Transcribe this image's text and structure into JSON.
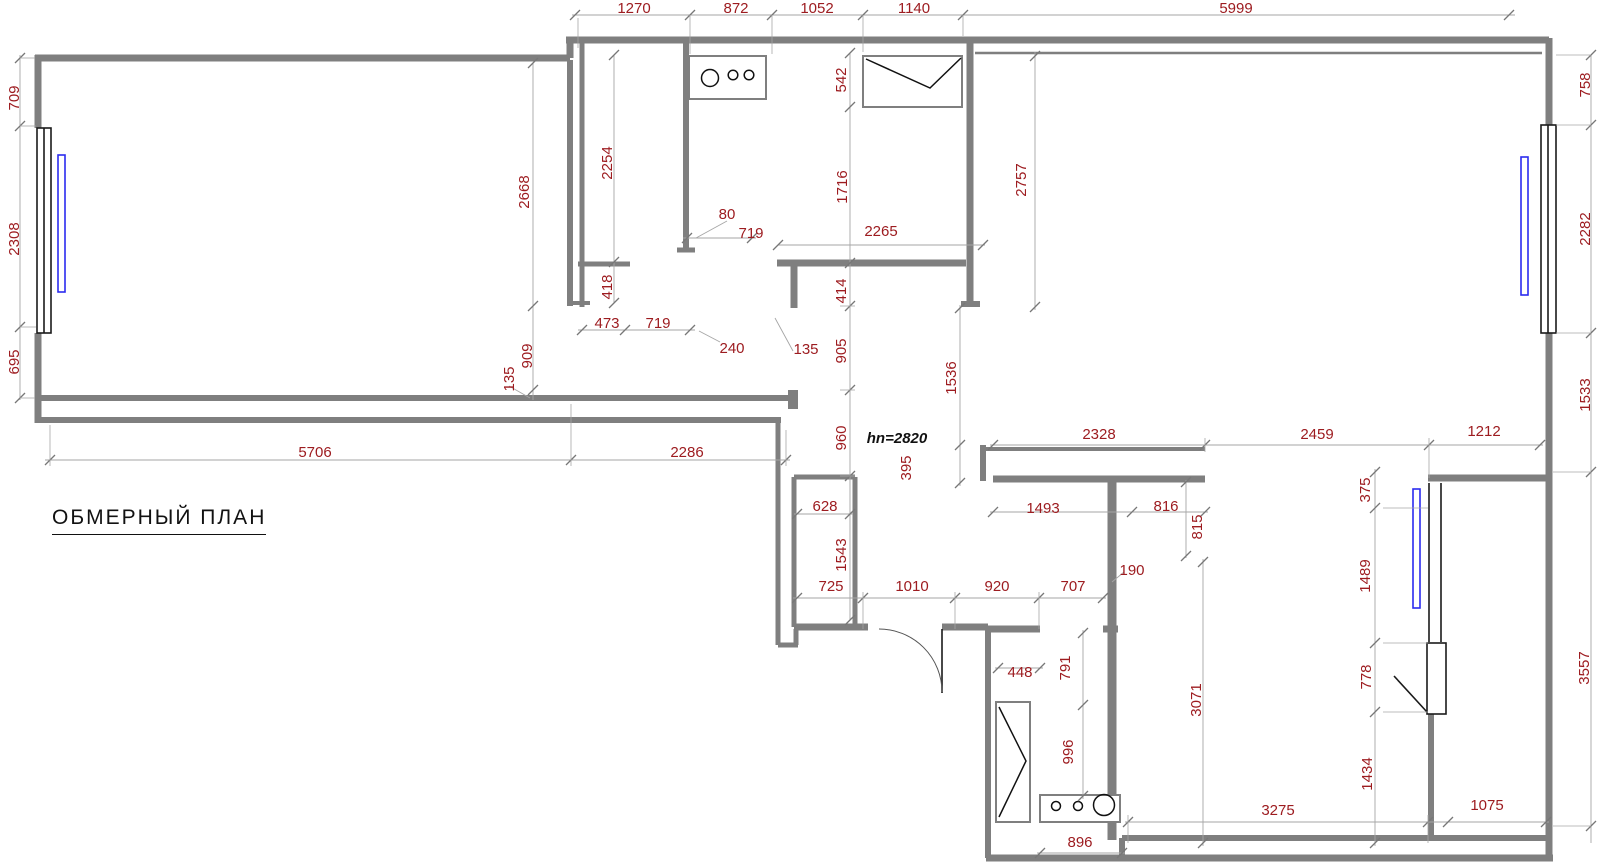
{
  "title": "ОБМЕРНЫЙ ПЛАН",
  "note": "hn=2820",
  "colors": {
    "background": "#ffffff",
    "wall": "#7f7f7f",
    "dimension_text": "#9d1c20",
    "dimension_line": "#a6a6a6",
    "window": "#1a1a1a",
    "radiator": "#2b2bee",
    "fixture": "#111111",
    "title": "#111111"
  },
  "dimensions": [
    {
      "label": "1270",
      "x": 634,
      "y": 13,
      "o": "h"
    },
    {
      "label": "872",
      "x": 736,
      "y": 13,
      "o": "h"
    },
    {
      "label": "1052",
      "x": 817,
      "y": 13,
      "o": "h"
    },
    {
      "label": "1140",
      "x": 914,
      "y": 13,
      "o": "h"
    },
    {
      "label": "5999",
      "x": 1236,
      "y": 13,
      "o": "h"
    },
    {
      "label": "709",
      "x": 19,
      "y": 98,
      "o": "v"
    },
    {
      "label": "2308",
      "x": 19,
      "y": 239,
      "o": "v"
    },
    {
      "label": "695",
      "x": 19,
      "y": 362,
      "o": "v"
    },
    {
      "label": "758",
      "x": 1590,
      "y": 85,
      "o": "v"
    },
    {
      "label": "2282",
      "x": 1590,
      "y": 229,
      "o": "v"
    },
    {
      "label": "1533",
      "x": 1590,
      "y": 395,
      "o": "v"
    },
    {
      "label": "3557",
      "x": 1589,
      "y": 668,
      "o": "v"
    },
    {
      "label": "2668",
      "x": 529,
      "y": 192,
      "o": "v"
    },
    {
      "label": "909",
      "x": 532,
      "y": 356,
      "o": "v"
    },
    {
      "label": "135",
      "x": 514,
      "y": 379,
      "o": "v"
    },
    {
      "label": "5706",
      "x": 315,
      "y": 457,
      "o": "h"
    },
    {
      "label": "2286",
      "x": 687,
      "y": 457,
      "o": "h"
    },
    {
      "label": "2254",
      "x": 612,
      "y": 163,
      "o": "v"
    },
    {
      "label": "418",
      "x": 612,
      "y": 287,
      "o": "v"
    },
    {
      "label": "473",
      "x": 607,
      "y": 328,
      "o": "h"
    },
    {
      "label": "719",
      "x": 658,
      "y": 328,
      "o": "h"
    },
    {
      "label": "80",
      "x": 727,
      "y": 219,
      "o": "h"
    },
    {
      "label": "719",
      "x": 751,
      "y": 238,
      "o": "h"
    },
    {
      "label": "240",
      "x": 732,
      "y": 353,
      "o": "h"
    },
    {
      "label": "542",
      "x": 846,
      "y": 80,
      "o": "v"
    },
    {
      "label": "1716",
      "x": 847,
      "y": 187,
      "o": "v"
    },
    {
      "label": "2265",
      "x": 881,
      "y": 236,
      "o": "h"
    },
    {
      "label": "414",
      "x": 846,
      "y": 291,
      "o": "v"
    },
    {
      "label": "135",
      "x": 806,
      "y": 354,
      "o": "h"
    },
    {
      "label": "905",
      "x": 846,
      "y": 351,
      "o": "v"
    },
    {
      "label": "960",
      "x": 846,
      "y": 438,
      "o": "v"
    },
    {
      "label": "2757",
      "x": 1026,
      "y": 180,
      "o": "v"
    },
    {
      "label": "1536",
      "x": 956,
      "y": 378,
      "o": "v"
    },
    {
      "label": "395",
      "x": 911,
      "y": 468,
      "o": "v"
    },
    {
      "label": "2328",
      "x": 1099,
      "y": 439,
      "o": "h"
    },
    {
      "label": "2459",
      "x": 1317,
      "y": 439,
      "o": "h"
    },
    {
      "label": "1212",
      "x": 1484,
      "y": 436,
      "o": "h"
    },
    {
      "label": "1493",
      "x": 1043,
      "y": 513,
      "o": "h"
    },
    {
      "label": "816",
      "x": 1166,
      "y": 511,
      "o": "h"
    },
    {
      "label": "815",
      "x": 1202,
      "y": 527,
      "o": "v"
    },
    {
      "label": "190",
      "x": 1132,
      "y": 575,
      "o": "h"
    },
    {
      "label": "628",
      "x": 825,
      "y": 511,
      "o": "h"
    },
    {
      "label": "1543",
      "x": 846,
      "y": 555,
      "o": "v"
    },
    {
      "label": "725",
      "x": 831,
      "y": 591,
      "o": "h"
    },
    {
      "label": "1010",
      "x": 912,
      "y": 591,
      "o": "h"
    },
    {
      "label": "920",
      "x": 997,
      "y": 591,
      "o": "h"
    },
    {
      "label": "707",
      "x": 1073,
      "y": 591,
      "o": "h"
    },
    {
      "label": "448",
      "x": 1020,
      "y": 677,
      "o": "h"
    },
    {
      "label": "791",
      "x": 1070,
      "y": 668,
      "o": "v"
    },
    {
      "label": "996",
      "x": 1073,
      "y": 752,
      "o": "v"
    },
    {
      "label": "896",
      "x": 1080,
      "y": 847,
      "o": "h"
    },
    {
      "label": "3071",
      "x": 1201,
      "y": 700,
      "o": "v"
    },
    {
      "label": "3275",
      "x": 1278,
      "y": 815,
      "o": "h"
    },
    {
      "label": "375",
      "x": 1370,
      "y": 490,
      "o": "v"
    },
    {
      "label": "1489",
      "x": 1370,
      "y": 576,
      "o": "v"
    },
    {
      "label": "778",
      "x": 1371,
      "y": 677,
      "o": "v"
    },
    {
      "label": "1434",
      "x": 1372,
      "y": 774,
      "o": "v"
    },
    {
      "label": "1075",
      "x": 1487,
      "y": 810,
      "o": "h"
    },
    {
      "label": "hn=2820",
      "x": 897,
      "y": 443,
      "o": "h",
      "style": "note"
    }
  ]
}
